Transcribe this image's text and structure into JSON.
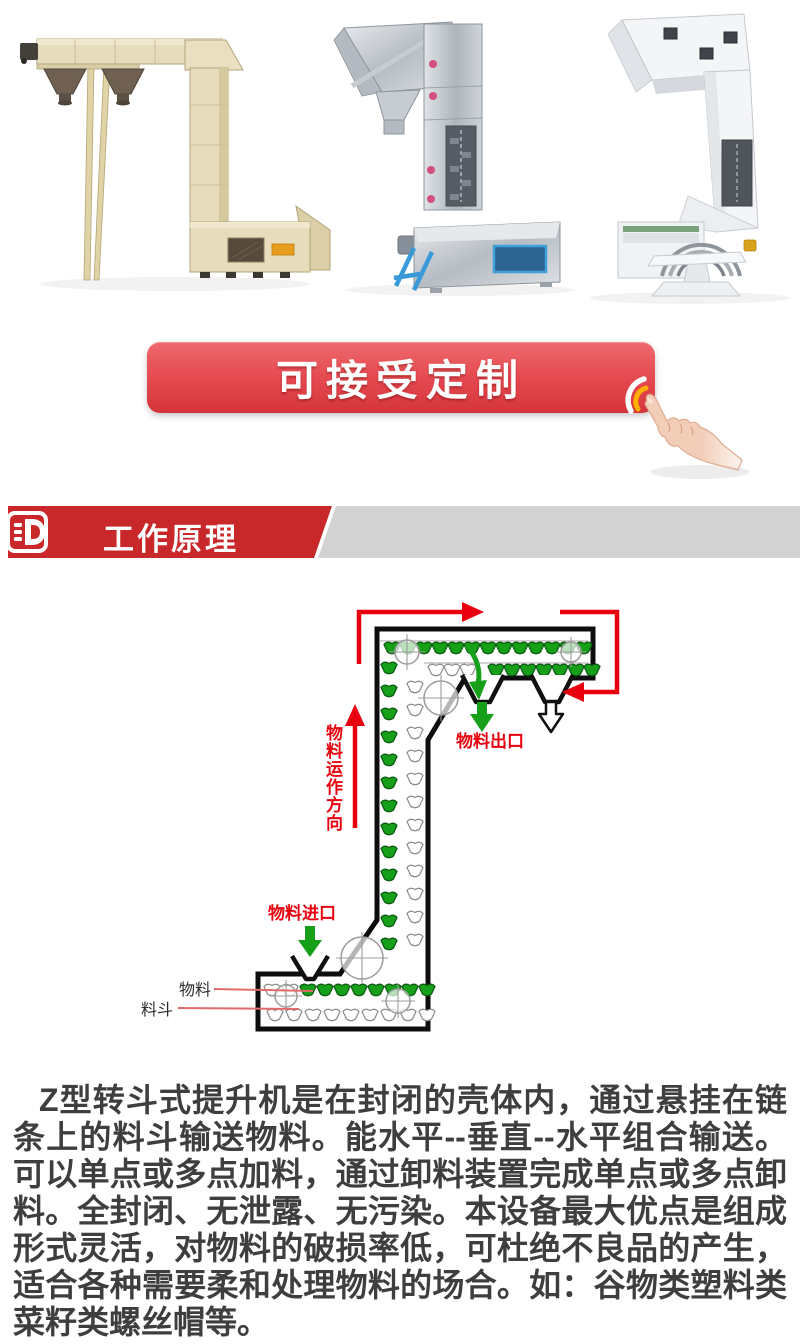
{
  "hero": {
    "photos": [
      "beige-z-bucket-elevator",
      "stainless-steel-z-bucket-elevator",
      "white-z-bucket-elevator"
    ]
  },
  "cta": {
    "label": "可接受定制"
  },
  "section": {
    "title": "工作原理"
  },
  "diagram": {
    "direction_label": "物料运作方向",
    "outlet_label": "物料出口",
    "inlet_label": "物料进口",
    "material_label": "物料",
    "bucket_label": "料斗"
  },
  "description": "Z型转斗式提升机是在封闭的壳体内，通过悬挂在链条上的料斗输送物料。能水平--垂直--水平组合输送。可以单点或多点加料，通过卸料装置完成单点或多点卸料。全封闭、无泄露、无污染。本设备最大优点是组成形式灵活，对物料的破损率低，可杜绝不良品的产生，适合各种需要柔和处理物料的场合。如：谷物类塑料类菜籽类螺丝帽等。",
  "colors": {
    "accent_red": "#c9282a",
    "banner_gray": "#d2d2d2",
    "arrow_red": "#e8000e",
    "bucket_green": "#16a01a",
    "button_top": "#ee686d",
    "button_bottom": "#d4343b",
    "text": "#3e3e3e"
  }
}
